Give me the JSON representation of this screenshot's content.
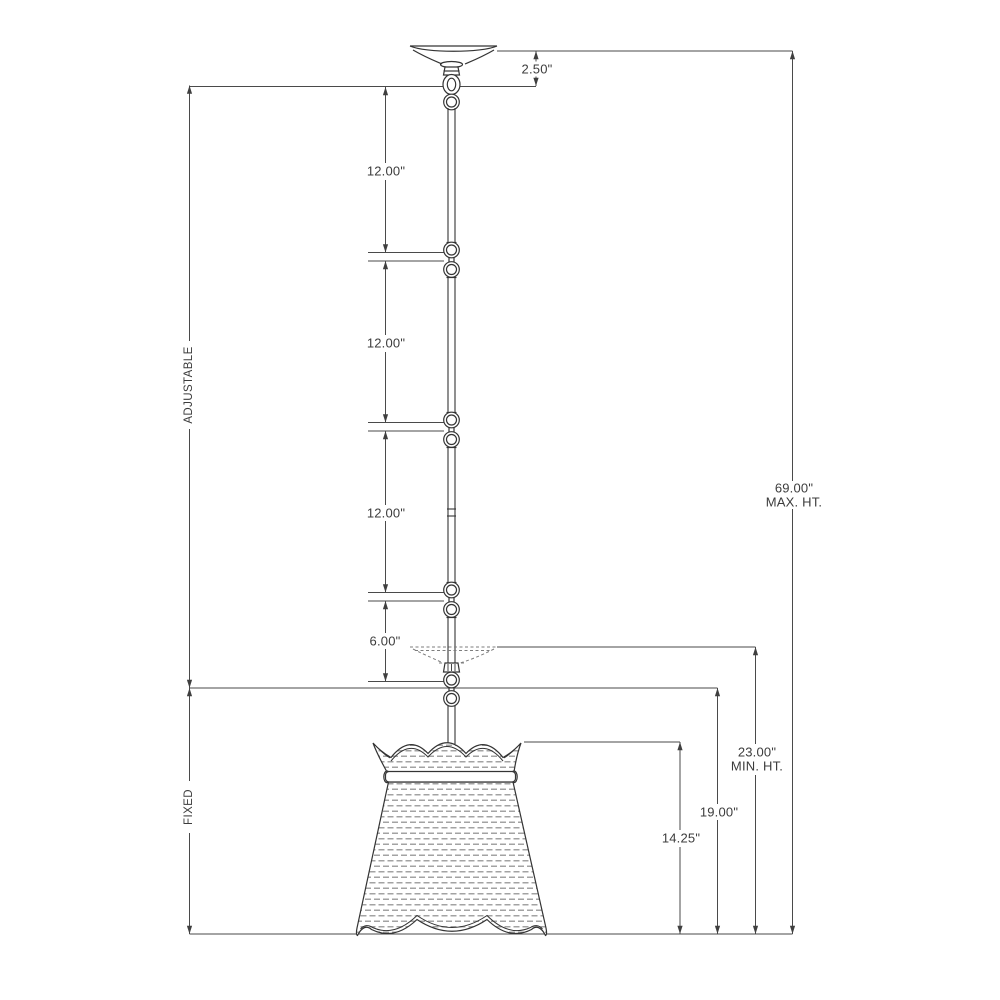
{
  "diagram": {
    "type": "pendant-light-fixture-dimension-drawing",
    "dimensions": {
      "canopy_height": "2.50\"",
      "stem_section_1": "12.00\"",
      "stem_section_2": "12.00\"",
      "stem_section_3": "12.00\"",
      "stem_section_4": "6.00\"",
      "adjustable_label": "ADJUSTABLE",
      "fixed_label": "FIXED",
      "max_height": "69.00\"",
      "max_height_caption": "MAX. HT.",
      "min_height": "23.00\"",
      "min_height_caption": "MIN. HT.",
      "fixed_drop_height": "19.00\"",
      "shade_height": "14.25\""
    },
    "colors": {
      "dimension_line": "#4a4a4a",
      "fixture_line": "#343434",
      "texture": "#a3a3a3",
      "background": "#ffffff"
    }
  }
}
